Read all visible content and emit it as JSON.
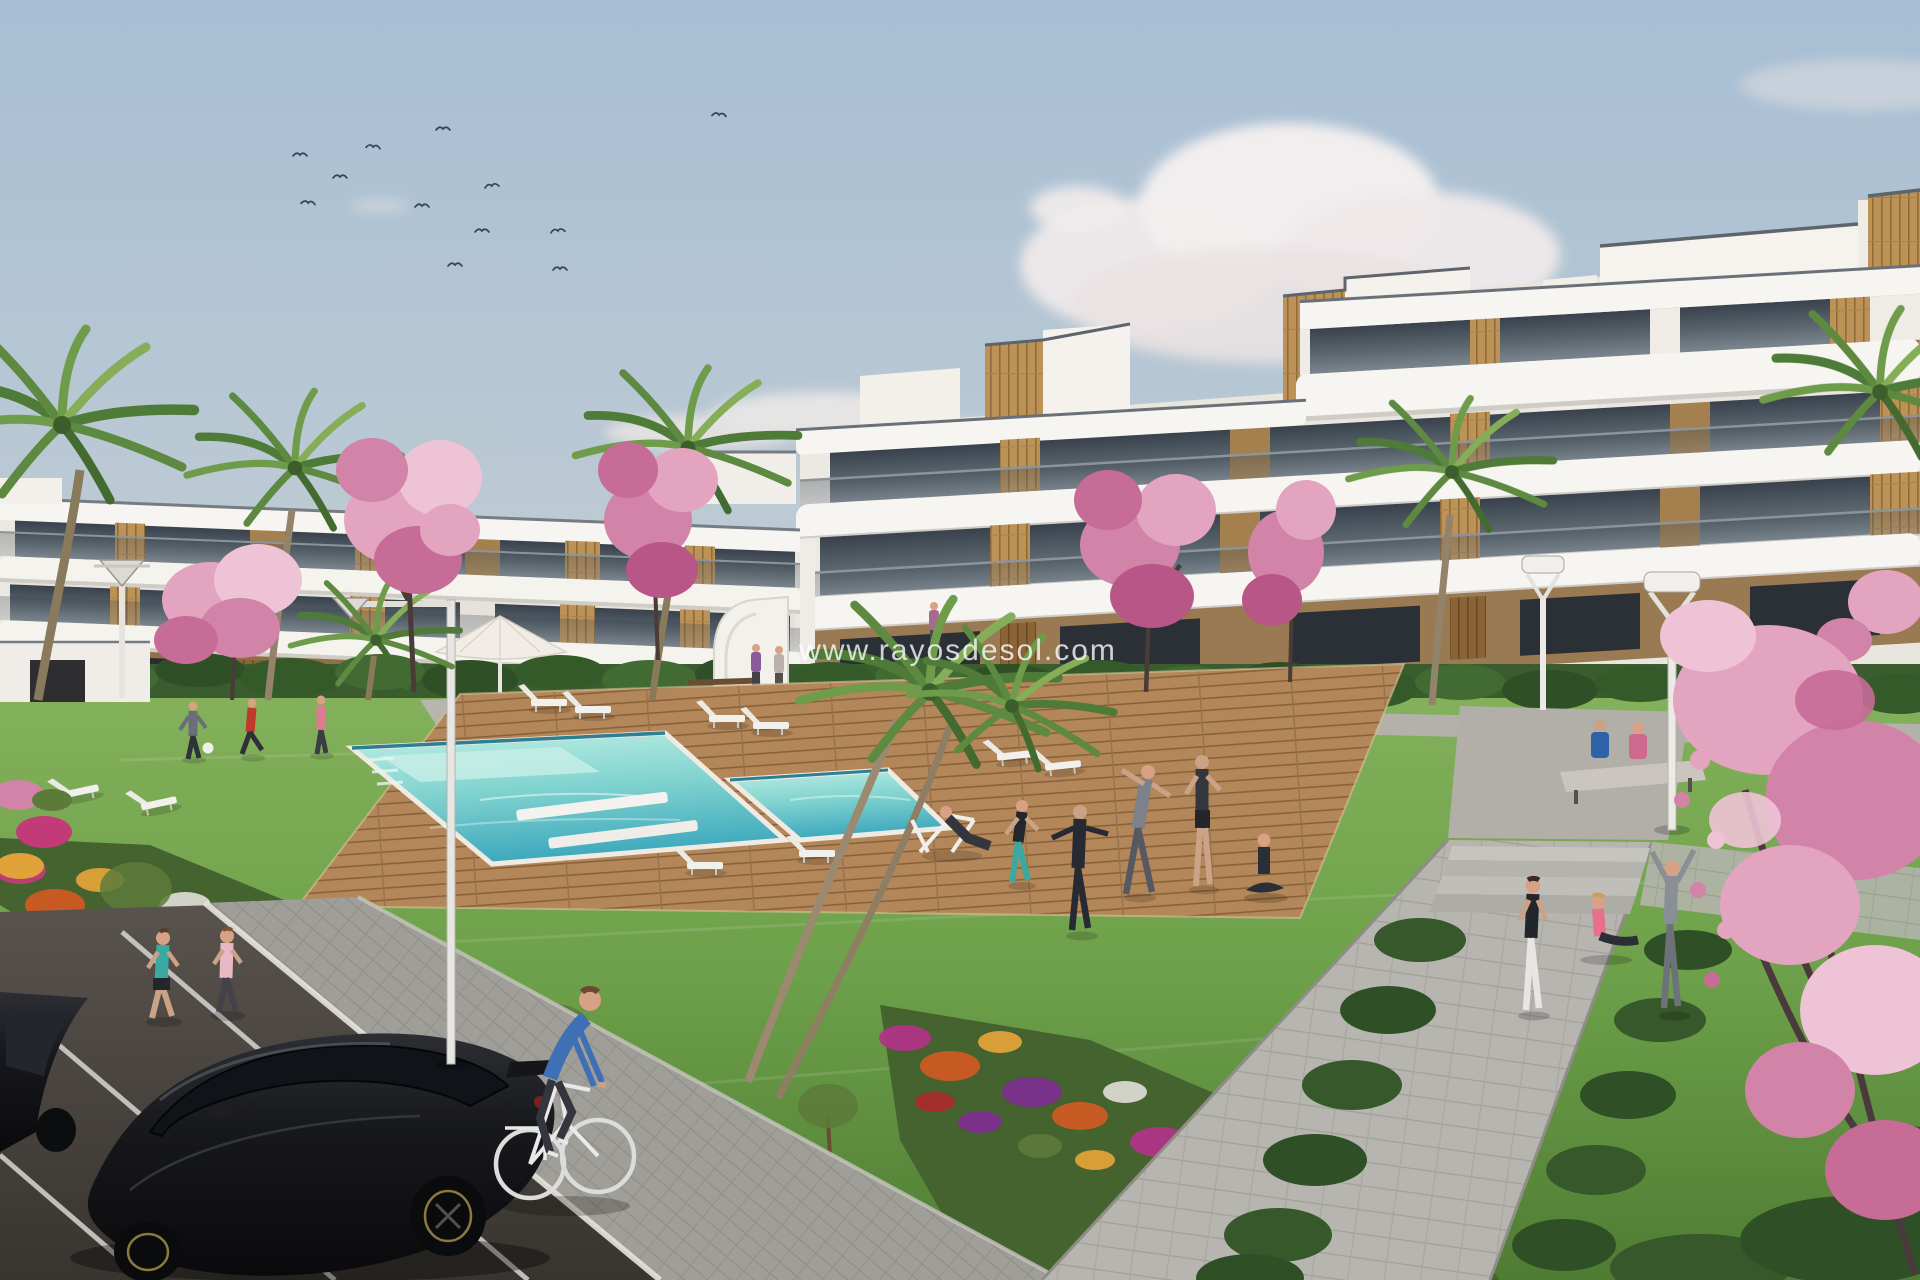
{
  "watermark": {
    "text": "www.rayosdesol.com"
  },
  "scene": {
    "kind": "architectural 3D render",
    "subject": "new-build apartment complex with communal lawn, swimming pool, flower beds, parking and people exercising",
    "sky": {
      "clouds": "white cumulus right of center, thin wisps mid-sky",
      "birds": 12
    },
    "vehicles": {
      "parked_black_cars": 2,
      "bicycle_riders": 1
    }
  },
  "palette": {
    "sky_top": "#a7bed4",
    "sky_horizon": "#d6dad5",
    "cloud": "#f2edee",
    "building_white": "#f6f4f0",
    "building_shadow": "#d8d4ce",
    "wood_accent": "#b98f58",
    "window_glass": "#46505a",
    "lawn_green": "#6fa04c",
    "hedge_green": "#3c6030",
    "pool_water": "#5fc2c8",
    "pool_deck_wood": "#b3875a",
    "flower_orange": "#cf5a22",
    "flower_magenta": "#b03487",
    "flower_purple": "#7c2f8e",
    "blossom_pink": "#e3a4c0",
    "path_gray": "#b7b5b0",
    "asphalt_gray": "#474340",
    "car_black": "#141518",
    "cyclist_blue": "#3f6fb5",
    "watermark_white": "#ffffff"
  }
}
